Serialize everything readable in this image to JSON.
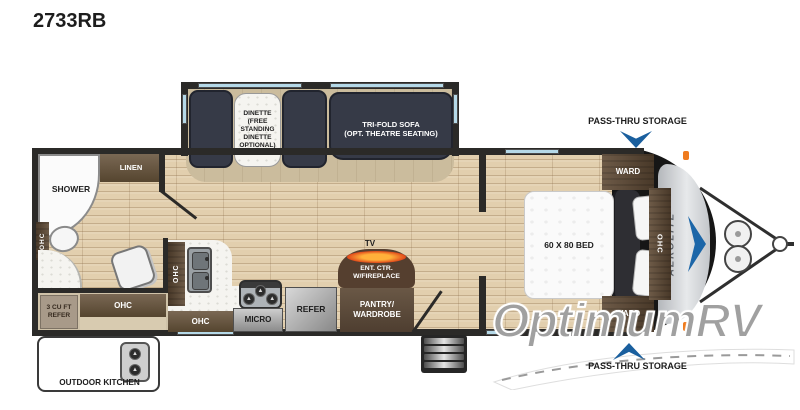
{
  "title": "2733RB",
  "watermark": {
    "text": "OptimumRV"
  },
  "exterior": {
    "front_storage_label": "PASS-THRU STORAGE",
    "rear_storage_label": "PASS-THRU STORAGE",
    "outdoor_kitchen_label": "OUTDOOR KITCHEN",
    "brand_logo": "AEROLITE"
  },
  "rooms": {
    "living": {
      "dinette_label": "DINETTE\n(FREE\nSTANDING\nDINETTE\nOPTIONAL)",
      "sofa_label": "TRI-FOLD SOFA\n(OPT. THEATRE SEATING)",
      "tv_label": "TV",
      "ent_ctr_label": "ENT. CTR.\nW/FIREPLACE",
      "pantry_label": "PANTRY/\nWARDROBE"
    },
    "kitchen": {
      "micro_label": "MICRO",
      "refer_label": "REFER",
      "ohc_upper_label": "OHC",
      "ohc_lower_label": "OHC"
    },
    "bathroom": {
      "shower_label": "SHOWER",
      "linen_label": "LINEN",
      "ohc_label": "OHC"
    },
    "rear_exterior": {
      "mini_fridge_label": "3 CU FT\nREFER",
      "ohc_label": "OHC"
    },
    "bedroom": {
      "bed_label": "60 X 80 BED",
      "ward_top_label": "WARD",
      "ward_bottom_label": "WARD",
      "ohc_label": "OHC"
    }
  },
  "colors": {
    "accent_blue": "#1a5f9e",
    "cabinet_brown": "#5d4c3d",
    "floor_wood": "#e2cfae",
    "wall": "#2b2a28",
    "window_blue": "#b5d9e8",
    "marker_orange": "#ef7b1e"
  }
}
